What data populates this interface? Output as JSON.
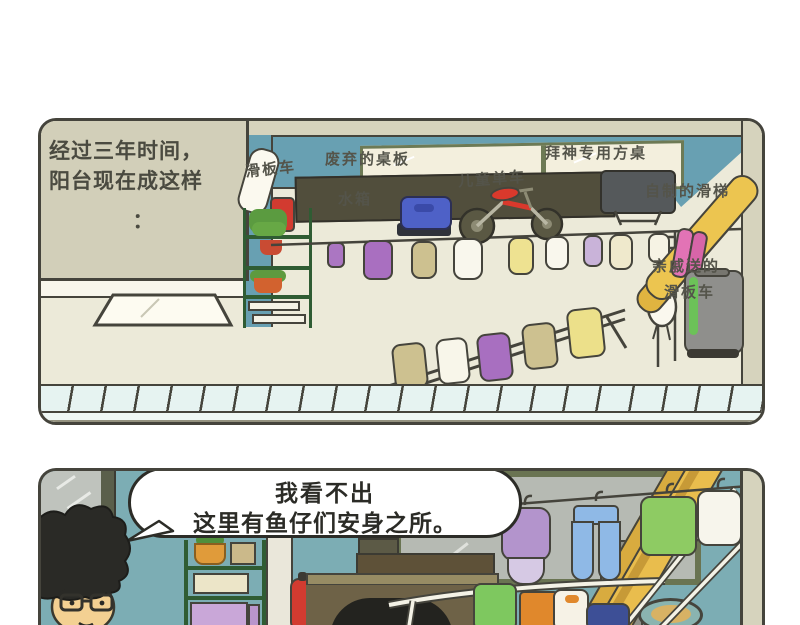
{
  "panel1": {
    "narration_line1": "经过三年时间，",
    "narration_line2": "阳台现在成这样",
    "narration_line3": "：",
    "labels": {
      "scooter": "滑板车",
      "discarded_table_board": "废弃的桌板",
      "water_tank": "水箱",
      "kids_bike": "儿童单车",
      "worship_square_table": "拜神专用方桌",
      "homemade_slide": "自制的滑梯",
      "relatives_gift_line1": "亲戚送的",
      "relatives_gift_line2": "滑板车"
    }
  },
  "panel2": {
    "speech_bubble": {
      "line1": "我看不出",
      "line2": "这里有鱼仔们安身之所。"
    }
  },
  "colors": {
    "outline": "#45443c",
    "floor_cream": "#ecead9",
    "indoor_wall_beige": "#d2cfb9",
    "balcony_wall_teal": "#68a0b2",
    "room_wall_teal": "#7cadb4",
    "railing_blue": "#e6f3f1",
    "slide_yellow": "#ecc550",
    "bike_red": "#d9392c",
    "water_tank_blue": "#4e61c7",
    "extinguisher_red": "#d23b30",
    "shelf_green": "#2f5c33",
    "scooter_pink": "#e273b5",
    "gray_scooter": "#8f8f8c",
    "purple_cloth": "#ab76c2",
    "blue_pants": "#8fb9e6",
    "green_shirt": "#8ecb63"
  }
}
